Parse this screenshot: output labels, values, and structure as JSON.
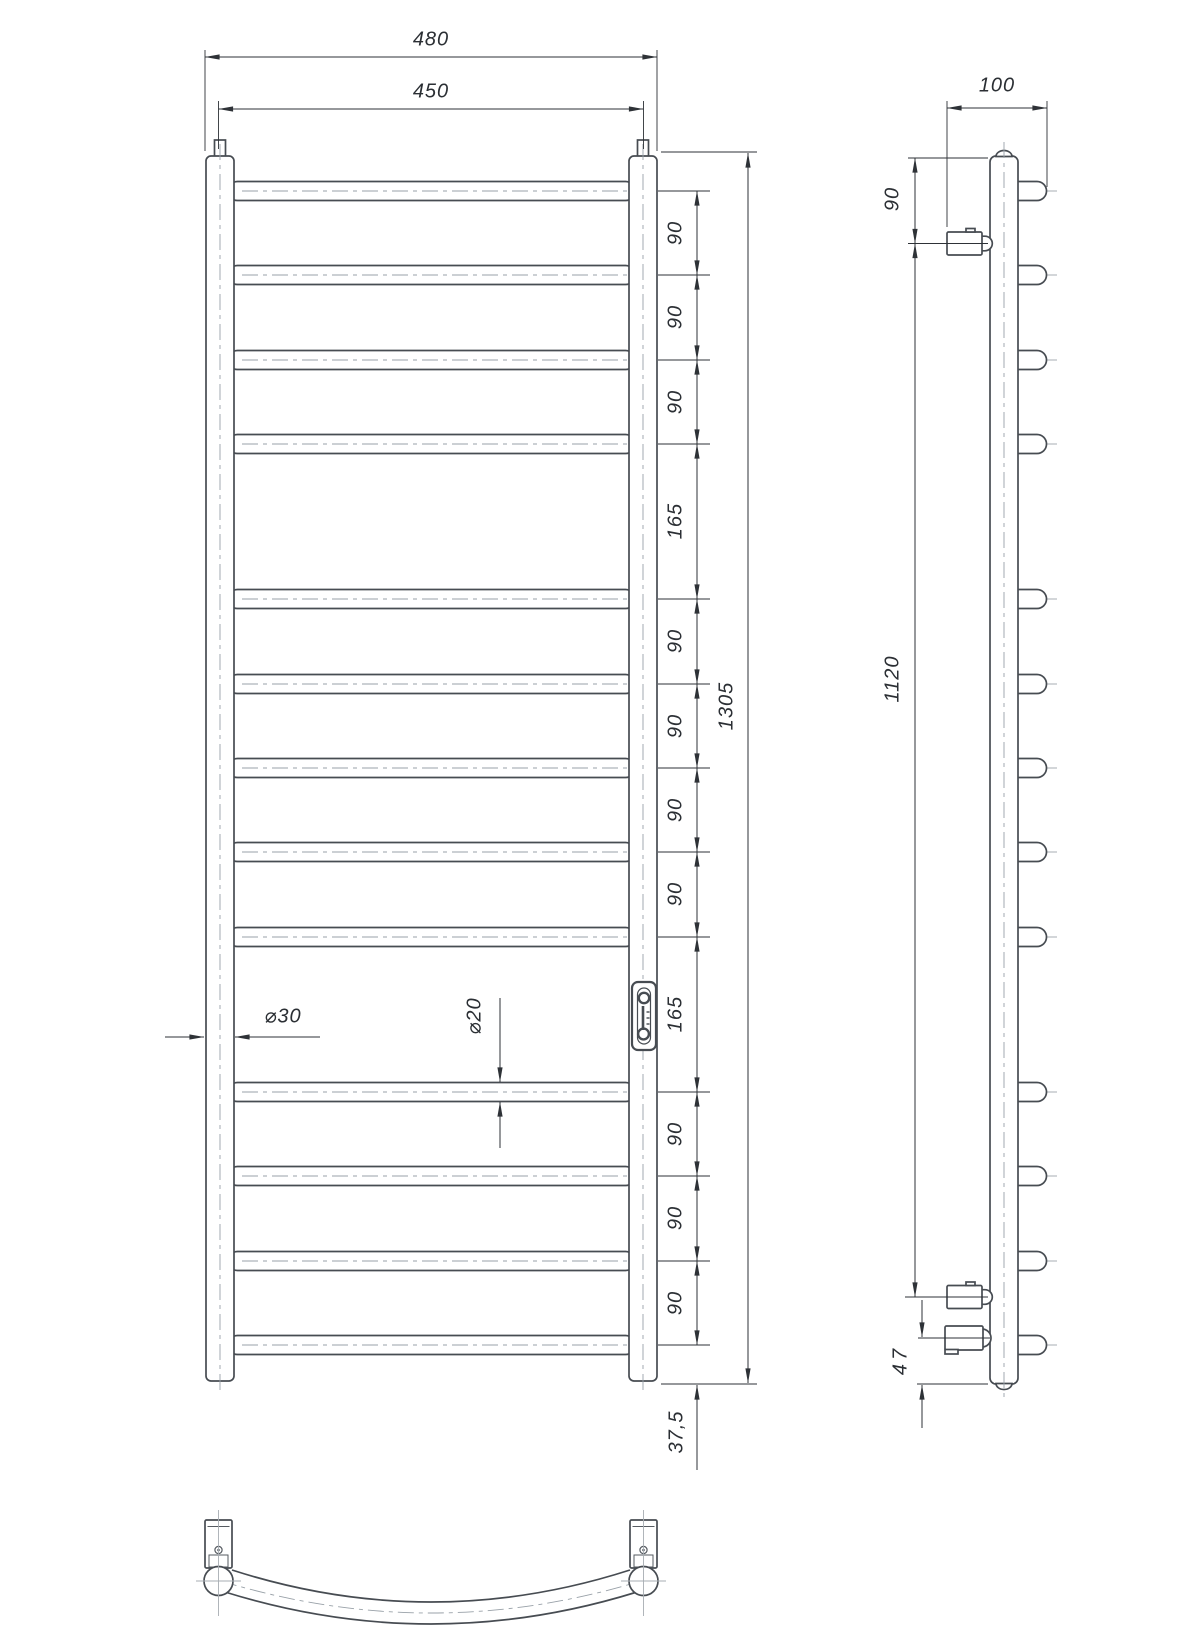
{
  "front_view": {
    "overall_width": "480",
    "axis_width": "450",
    "overall_height": "1305",
    "bottom_offset": "37,5",
    "collector_diameter": "⌀30",
    "rung_diameter": "⌀20",
    "rung_spacings": [
      "90",
      "90",
      "90",
      "165",
      "90",
      "90",
      "90",
      "90",
      "165",
      "90",
      "90",
      "90"
    ]
  },
  "side_view": {
    "depth": "100",
    "top_bracket_offset": "90",
    "bracket_distance": "1120",
    "bottom_connection_offset": "47"
  },
  "icons": {
    "brand_badge": "thermometer-badge-icon"
  }
}
